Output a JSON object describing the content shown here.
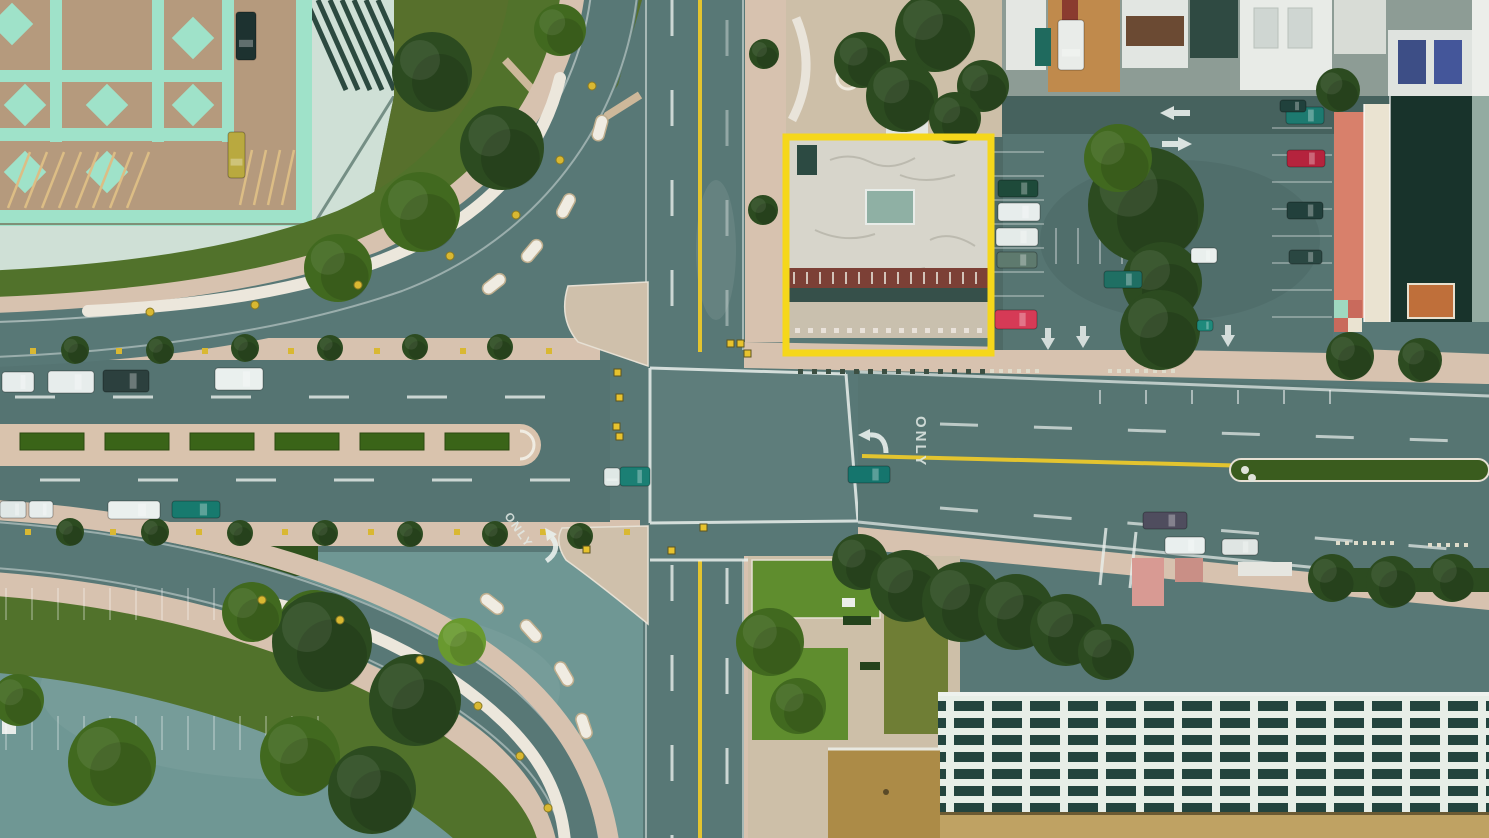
{
  "scene": {
    "description": "Aerial top-down drone view of a city street intersection with a building highlighted by a yellow box",
    "view": "top-down aerial photo"
  },
  "annotation": {
    "name": "highlight-box",
    "x": 786,
    "y": 137,
    "width": 205,
    "height": 216,
    "color": "#F5D71B",
    "thickness": 7
  },
  "road_markings": {
    "only_east": {
      "text": "ONLY",
      "x": 916,
      "y": 416,
      "rotation": 90
    },
    "only_south": {
      "text": "ONLY",
      "x": 504,
      "y": 516,
      "rotation": 55
    }
  },
  "palette": {
    "road": "#587876",
    "road_dark": "#46625e",
    "lot_sw": "#6f9794",
    "lot_ne": "#567572",
    "sidewalk": "#d7c2af",
    "sidewalk_light": "#ddc9b4",
    "plaza": "#cdbfa8",
    "deck_tan": "#b59a7d",
    "mint": "#9fe2c9",
    "pale_roof": "#cfe0d6",
    "dark_roof": "#23443c",
    "grass": "#57702c",
    "grass_bright": "#5f8d2e",
    "lawn_olive": "#6f7e35",
    "tree_dark": "#2c4b20",
    "tree_mid": "#41691f",
    "tree_bright": "#69992f",
    "lane_yellow": "#e3c42f",
    "marking_white": "#e9efec",
    "roof_white": "#d7d5cb",
    "brick": "#7c4036",
    "coral": "#d8806b",
    "cream": "#eae3d1",
    "orange_brick": "#bf6f3a",
    "grid_cell": "#23443e",
    "grid_line": "#e7eee7",
    "tan_band": "#bfa263",
    "ochre": "#ac8b47",
    "pink_path": "#d89a93",
    "canopy": "#ece7dc",
    "dot_yellow": "#d9b832"
  },
  "cars": [
    [
      2,
      372,
      32,
      20,
      "#e7edec"
    ],
    [
      48,
      371,
      46,
      22,
      "#e7edec"
    ],
    [
      103,
      370,
      46,
      22,
      "#2c403e"
    ],
    [
      215,
      368,
      48,
      22,
      "#eaf0ee"
    ],
    [
      0,
      501,
      26,
      17,
      "#e0e8e7"
    ],
    [
      29,
      501,
      24,
      17,
      "#e7edec"
    ],
    [
      108,
      501,
      52,
      18,
      "#eaf0ee"
    ],
    [
      172,
      501,
      48,
      17,
      "#177a6e"
    ],
    [
      604,
      468,
      16,
      18,
      "#dfe8e6"
    ],
    [
      620,
      467,
      30,
      19,
      "#1b7f74"
    ],
    [
      848,
      466,
      42,
      17,
      "#15756d"
    ],
    [
      1143,
      512,
      44,
      17,
      "#4f4d5e"
    ],
    [
      1165,
      537,
      40,
      17,
      "#e9efee"
    ],
    [
      1222,
      539,
      36,
      16,
      "#dfe5e3"
    ],
    [
      998,
      180,
      40,
      17,
      "#1e4a3a"
    ],
    [
      998,
      203,
      42,
      18,
      "#e7edec"
    ],
    [
      996,
      228,
      42,
      18,
      "#e4ebe9"
    ],
    [
      997,
      252,
      40,
      16,
      "#5e7a6e"
    ],
    [
      995,
      310,
      42,
      19,
      "#d63a56"
    ],
    [
      1286,
      107,
      38,
      17,
      "#1d7a70"
    ],
    [
      1287,
      150,
      38,
      17,
      "#b5233d"
    ],
    [
      1287,
      202,
      36,
      17,
      "#22403c"
    ],
    [
      1289,
      250,
      33,
      14,
      "#2a4742"
    ],
    [
      1191,
      248,
      26,
      15,
      "#e9efed"
    ],
    [
      1104,
      271,
      38,
      17,
      "#1f6f63"
    ],
    [
      1197,
      320,
      16,
      11,
      "#1f8a7c"
    ],
    [
      1058,
      20,
      26,
      50,
      "#e9ece9"
    ],
    [
      236,
      12,
      20,
      48,
      "#1d3230"
    ],
    [
      228,
      132,
      17,
      46,
      "#b9a93f"
    ],
    [
      1280,
      100,
      26,
      12,
      "#20413c"
    ]
  ],
  "trees": [
    [
      935,
      32,
      40,
      "dark"
    ],
    [
      983,
      86,
      26,
      "dark"
    ],
    [
      906,
      112,
      20,
      "dark"
    ],
    [
      862,
      60,
      28,
      "dark"
    ],
    [
      764,
      54,
      15,
      "dark"
    ],
    [
      763,
      210,
      15,
      "dark"
    ],
    [
      1146,
      205,
      58,
      "dark"
    ],
    [
      1162,
      282,
      40,
      "dark"
    ],
    [
      1118,
      158,
      34,
      "mid"
    ],
    [
      1160,
      330,
      40,
      "dark"
    ],
    [
      902,
      96,
      36,
      "dark"
    ],
    [
      955,
      118,
      26,
      "dark"
    ],
    [
      1350,
      356,
      24,
      "dark"
    ],
    [
      1420,
      360,
      22,
      "dark"
    ],
    [
      1338,
      90,
      22,
      "dark"
    ],
    [
      432,
      72,
      40,
      "dark"
    ],
    [
      502,
      148,
      42,
      "dark"
    ],
    [
      420,
      212,
      40,
      "mid"
    ],
    [
      338,
      268,
      34,
      "mid"
    ],
    [
      560,
      30,
      26,
      "mid"
    ],
    [
      18,
      700,
      26,
      "mid"
    ],
    [
      112,
      762,
      44,
      "mid"
    ],
    [
      300,
      756,
      40,
      "mid"
    ],
    [
      314,
      626,
      36,
      "mid"
    ],
    [
      322,
      642,
      50,
      "dark"
    ],
    [
      415,
      700,
      46,
      "dark"
    ],
    [
      372,
      790,
      44,
      "dark"
    ],
    [
      252,
      612,
      30,
      "mid"
    ],
    [
      462,
      642,
      24,
      "bright"
    ],
    [
      860,
      562,
      28,
      "dark"
    ],
    [
      906,
      586,
      36,
      "dark"
    ],
    [
      962,
      602,
      40,
      "dark"
    ],
    [
      1016,
      612,
      38,
      "dark"
    ],
    [
      1066,
      630,
      36,
      "dark"
    ],
    [
      1106,
      652,
      28,
      "dark"
    ],
    [
      770,
      642,
      34,
      "mid"
    ],
    [
      798,
      706,
      28,
      "mid"
    ],
    [
      1332,
      578,
      24,
      "dark"
    ],
    [
      1392,
      582,
      26,
      "dark"
    ],
    [
      1452,
      578,
      24,
      "dark"
    ],
    [
      75,
      350,
      14,
      "dark"
    ],
    [
      160,
      350,
      14,
      "dark"
    ],
    [
      245,
      348,
      14,
      "dark"
    ],
    [
      330,
      348,
      13,
      "dark"
    ],
    [
      415,
      347,
      13,
      "dark"
    ],
    [
      500,
      347,
      13,
      "dark"
    ],
    [
      70,
      532,
      14,
      "dark"
    ],
    [
      155,
      532,
      14,
      "dark"
    ],
    [
      240,
      533,
      13,
      "dark"
    ],
    [
      325,
      533,
      13,
      "dark"
    ],
    [
      410,
      534,
      13,
      "dark"
    ],
    [
      495,
      534,
      13,
      "dark"
    ],
    [
      580,
      536,
      13,
      "dark"
    ]
  ],
  "hedges": {
    "y": 433,
    "w": 64,
    "h": 17,
    "xs": [
      20,
      105,
      190,
      275,
      360,
      445
    ]
  },
  "median_east": {
    "x": 1230,
    "y": 459,
    "w": 259,
    "h": 22
  },
  "signals": [
    [
      614,
      369
    ],
    [
      616,
      394
    ],
    [
      613,
      423
    ],
    [
      616,
      433
    ],
    [
      727,
      340
    ],
    [
      737,
      340
    ],
    [
      583,
      546
    ],
    [
      668,
      547
    ],
    [
      744,
      350
    ],
    [
      700,
      524
    ]
  ],
  "meters": [
    {
      "y": 348,
      "xs": [
        30,
        116,
        202,
        288,
        374,
        460,
        546
      ]
    },
    {
      "y": 529,
      "xs": [
        25,
        110,
        196,
        282,
        368,
        454,
        540,
        624
      ]
    }
  ],
  "arrows": [
    {
      "x": 1160,
      "y": 113,
      "dir": "left"
    },
    {
      "x": 1162,
      "y": 144,
      "dir": "right"
    },
    {
      "x": 870,
      "y": 441,
      "dir": "turn-left"
    },
    {
      "x": 547,
      "y": 541,
      "dir": "turn-down-left"
    },
    {
      "x": 1048,
      "y": 340,
      "dir": "down"
    },
    {
      "x": 1083,
      "y": 338,
      "dir": "down"
    },
    {
      "x": 1228,
      "y": 337,
      "dir": "down"
    }
  ],
  "stalls_v": [
    {
      "x0": 6,
      "x1": 246,
      "step": 26,
      "y1": 588,
      "y2": 620,
      "c": "#ffffff",
      "o": 0.28
    },
    {
      "x0": 6,
      "x1": 324,
      "step": 26,
      "y1": 716,
      "y2": 750,
      "c": "#ffffff",
      "o": 0.28
    },
    {
      "x0": 1056,
      "x1": 1124,
      "step": 22,
      "y1": 228,
      "y2": 264,
      "c": "#ffffff",
      "o": 0.35
    },
    {
      "x0": 1100,
      "x1": 1330,
      "step": 46,
      "y1": 390,
      "y2": 404,
      "c": "#ffffff",
      "o": 0.5
    },
    {
      "x0": 794,
      "x1": 986,
      "step": 13,
      "y1": 272,
      "y2": 284,
      "c": "#e8e4da",
      "o": 0.8
    }
  ],
  "stalls_h": [
    {
      "y0": 128,
      "y1": 318,
      "step": 27,
      "x1": 1272,
      "x2": 1332,
      "c": "#ffffff",
      "o": 0.3
    },
    {
      "y0": 152,
      "y1": 300,
      "step": 24,
      "x1": 994,
      "x2": 1044,
      "c": "#ffffff",
      "o": 0.3
    }
  ],
  "dot_rows": [
    {
      "x0": 990,
      "x1": 1040,
      "step": 9,
      "y": 369,
      "size": 4,
      "color": "#dfdccb"
    },
    {
      "x0": 1108,
      "x1": 1178,
      "step": 9,
      "y": 369,
      "size": 4,
      "color": "#dfdccb"
    },
    {
      "x0": 1336,
      "x1": 1392,
      "step": 9,
      "y": 541,
      "size": 4,
      "color": "#dfdccb"
    },
    {
      "x0": 1428,
      "x1": 1470,
      "step": 9,
      "y": 543,
      "size": 4,
      "color": "#dfdccb"
    },
    {
      "x0": 798,
      "x1": 985,
      "step": 14,
      "y": 369,
      "size": 5,
      "color": "#3c4f42"
    },
    {
      "x0": 795,
      "x1": 985,
      "step": 13,
      "y": 328,
      "size": 5,
      "color": "#e9e2da"
    }
  ],
  "canopy_pods": [
    [
      600,
      128,
      -75
    ],
    [
      566,
      206,
      -62
    ],
    [
      532,
      251,
      -50
    ],
    [
      494,
      284,
      -38
    ],
    [
      492,
      604,
      38
    ],
    [
      531,
      631,
      48
    ],
    [
      564,
      674,
      60
    ],
    [
      584,
      726,
      72
    ]
  ],
  "canopy_dots": [
    [
      592,
      86
    ],
    [
      560,
      160
    ],
    [
      516,
      215
    ],
    [
      450,
      256
    ],
    [
      358,
      285
    ],
    [
      255,
      305
    ],
    [
      150,
      312
    ],
    [
      262,
      600
    ],
    [
      340,
      620
    ],
    [
      420,
      660
    ],
    [
      478,
      706
    ],
    [
      520,
      756
    ],
    [
      548,
      808
    ]
  ]
}
